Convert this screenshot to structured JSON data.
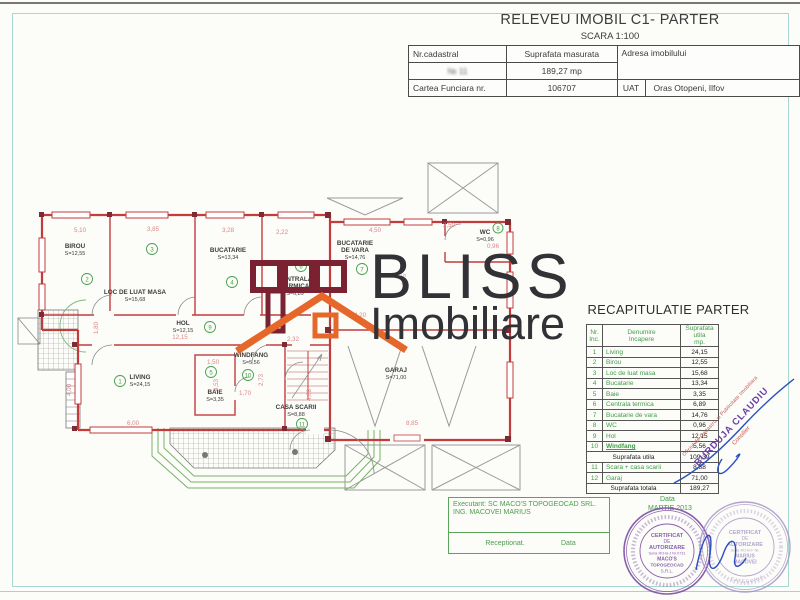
{
  "header": {
    "title": "RELEVEU IMOBIL C1- PARTER",
    "scale": "SCARA 1:100",
    "cadastral_label": "Nr.cadastral",
    "cadastral_value": "№ 11",
    "measured_label": "Suprafata masurata",
    "measured_value": "189,27 mp",
    "address_label": "Adresa imobilului",
    "land_book_label": "Cartea Funciara nr.",
    "land_book_value": "106707",
    "uat_label": "UAT",
    "uat_value": "Oras Otopeni, Ilfov"
  },
  "watermark": {
    "line1": "BLISS",
    "line2": "Imobiliare"
  },
  "floorplan": {
    "rooms": [
      {
        "num": "1",
        "name": "LIVING",
        "area": "S=24,15"
      },
      {
        "num": "2",
        "name": "BIROU",
        "area": "S=12,55"
      },
      {
        "num": "3",
        "name": "LOC DE LUAT MASA",
        "area": "S=15,68"
      },
      {
        "num": "4",
        "name": "BUCATARIE",
        "area": "S=13,34"
      },
      {
        "num": "5",
        "name": "BAIE",
        "area": "S=3,35"
      },
      {
        "num": "6",
        "name": "CENTRALA",
        "name2": "TERMICA",
        "area": "S=6,89"
      },
      {
        "num": "7",
        "name": "BUCATARIE",
        "name2": "DE VARA",
        "area": "S=14,76"
      },
      {
        "num": "8",
        "name": "WC",
        "area": "S=0,96"
      },
      {
        "num": "9",
        "name": "HOL",
        "area": "S=12,15"
      },
      {
        "num": "10",
        "name": "WINDFANG",
        "area": "S=5,56"
      },
      {
        "num": "11",
        "name": "CASA SCARII",
        "area": "S=8,88"
      },
      {
        "num": "12",
        "name": "GARAJ",
        "area": "S=71,00"
      }
    ],
    "dims": [
      "5,10",
      "3,85",
      "3,28",
      "2,22",
      "4,50",
      "2,50",
      "0,96",
      "4,55",
      "4,20",
      "12,15",
      "2,32",
      "1,50",
      "1,70",
      "2,73",
      "4,08",
      "4,53",
      "4,00",
      "1,80",
      "6,00",
      "8,85"
    ]
  },
  "recap": {
    "title": "RECAPITULATIE PARTER",
    "headers": {
      "nr": "Nr.\nInc.",
      "name": "Denumire\nIncapere",
      "area": "Suprafata\nutila\nmp."
    },
    "rows": [
      {
        "num": "1",
        "name": "Living",
        "area": "24,15"
      },
      {
        "num": "2",
        "name": "Birou",
        "area": "12,55"
      },
      {
        "num": "3",
        "name": "Loc de luat masa",
        "area": "15,68"
      },
      {
        "num": "4",
        "name": "Bucatarie",
        "area": "13,34"
      },
      {
        "num": "5",
        "name": "Baie",
        "area": "3,35"
      },
      {
        "num": "6",
        "name": "Centrala termica",
        "area": "6,89"
      },
      {
        "num": "7",
        "name": "Bucatarie de vara",
        "area": "14,76"
      },
      {
        "num": "8",
        "name": "WC",
        "area": "0,96"
      },
      {
        "num": "9",
        "name": "Hol",
        "area": "12,15"
      },
      {
        "num": "10",
        "name": "Windfang",
        "area": "5,56"
      }
    ],
    "subtotal_label": "Suprafata utila",
    "subtotal_value": "109,39",
    "extra_rows": [
      {
        "num": "11",
        "name": "Scara + casa scarii",
        "area": "8,88"
      },
      {
        "num": "12",
        "name": "Garaj",
        "area": "71,00"
      }
    ],
    "total_label": "Suprafata totala",
    "total_value": "189,27"
  },
  "footer": {
    "executant_line1": "Executant: SC MACO'S TOPOGEOCAD SRL.",
    "executant_line2": "ING. MACOVEI MARIUS",
    "receptionat_label": "Receptionat.",
    "data_label": "Data",
    "date_caption": "Data",
    "date_value": "MARTIE 2013"
  },
  "stamps": {
    "diagonal": {
      "office": "Oficiul de Cadastru si Publicitate Imobiliara",
      "name": "BURDUJA CLAUDIU",
      "role": "Consilier"
    },
    "round_left": {
      "l1": "CERTIFICAT",
      "l2": "DE",
      "l3": "AUTORIZARE",
      "l4": "Seria RO-B-J Nr.0731",
      "l5": "MACO'S",
      "l6": "TOPOGEOCAD",
      "l7": "S.R.L."
    },
    "round_right": {
      "l1": "CERTIFICAT",
      "l2": "DE",
      "l3": "AUTORIZARE",
      "l4": "Seria RO-B-F Nr.",
      "l5": "MARIUS",
      "l6": "MACOVEI",
      "ring": "CATEGORIA"
    }
  }
}
